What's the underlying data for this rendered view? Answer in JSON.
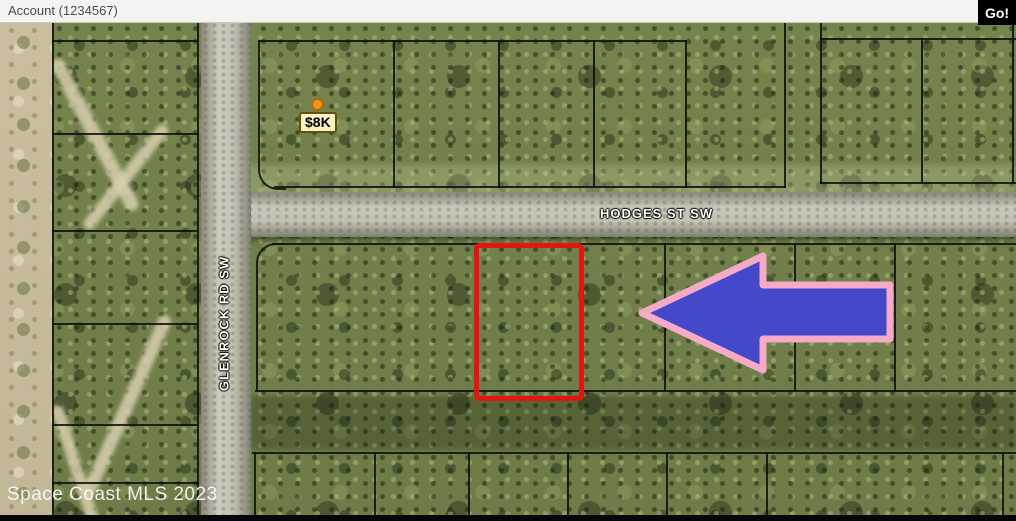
{
  "header": {
    "account_label": "Account (1234567)",
    "go_label": "Go!"
  },
  "map": {
    "price_marker": {
      "label": "$8K"
    },
    "streets": {
      "horizontal": "HODGES ST SW",
      "vertical": "GLENROCK RD SW"
    },
    "watermark": "Space Coast MLS 2023",
    "colors": {
      "arrow_fill": "#4349c8",
      "arrow_border": "#f5aac8",
      "highlight_parcel": "#e21511",
      "parcel_lines": "#0d0d0d",
      "marker_bg": "#fcf2bf",
      "marker_dot": "#f0941e",
      "road": "#c8c5b8",
      "topbar_bg": "#f3f3f1",
      "go_button_bg": "#000000"
    }
  }
}
